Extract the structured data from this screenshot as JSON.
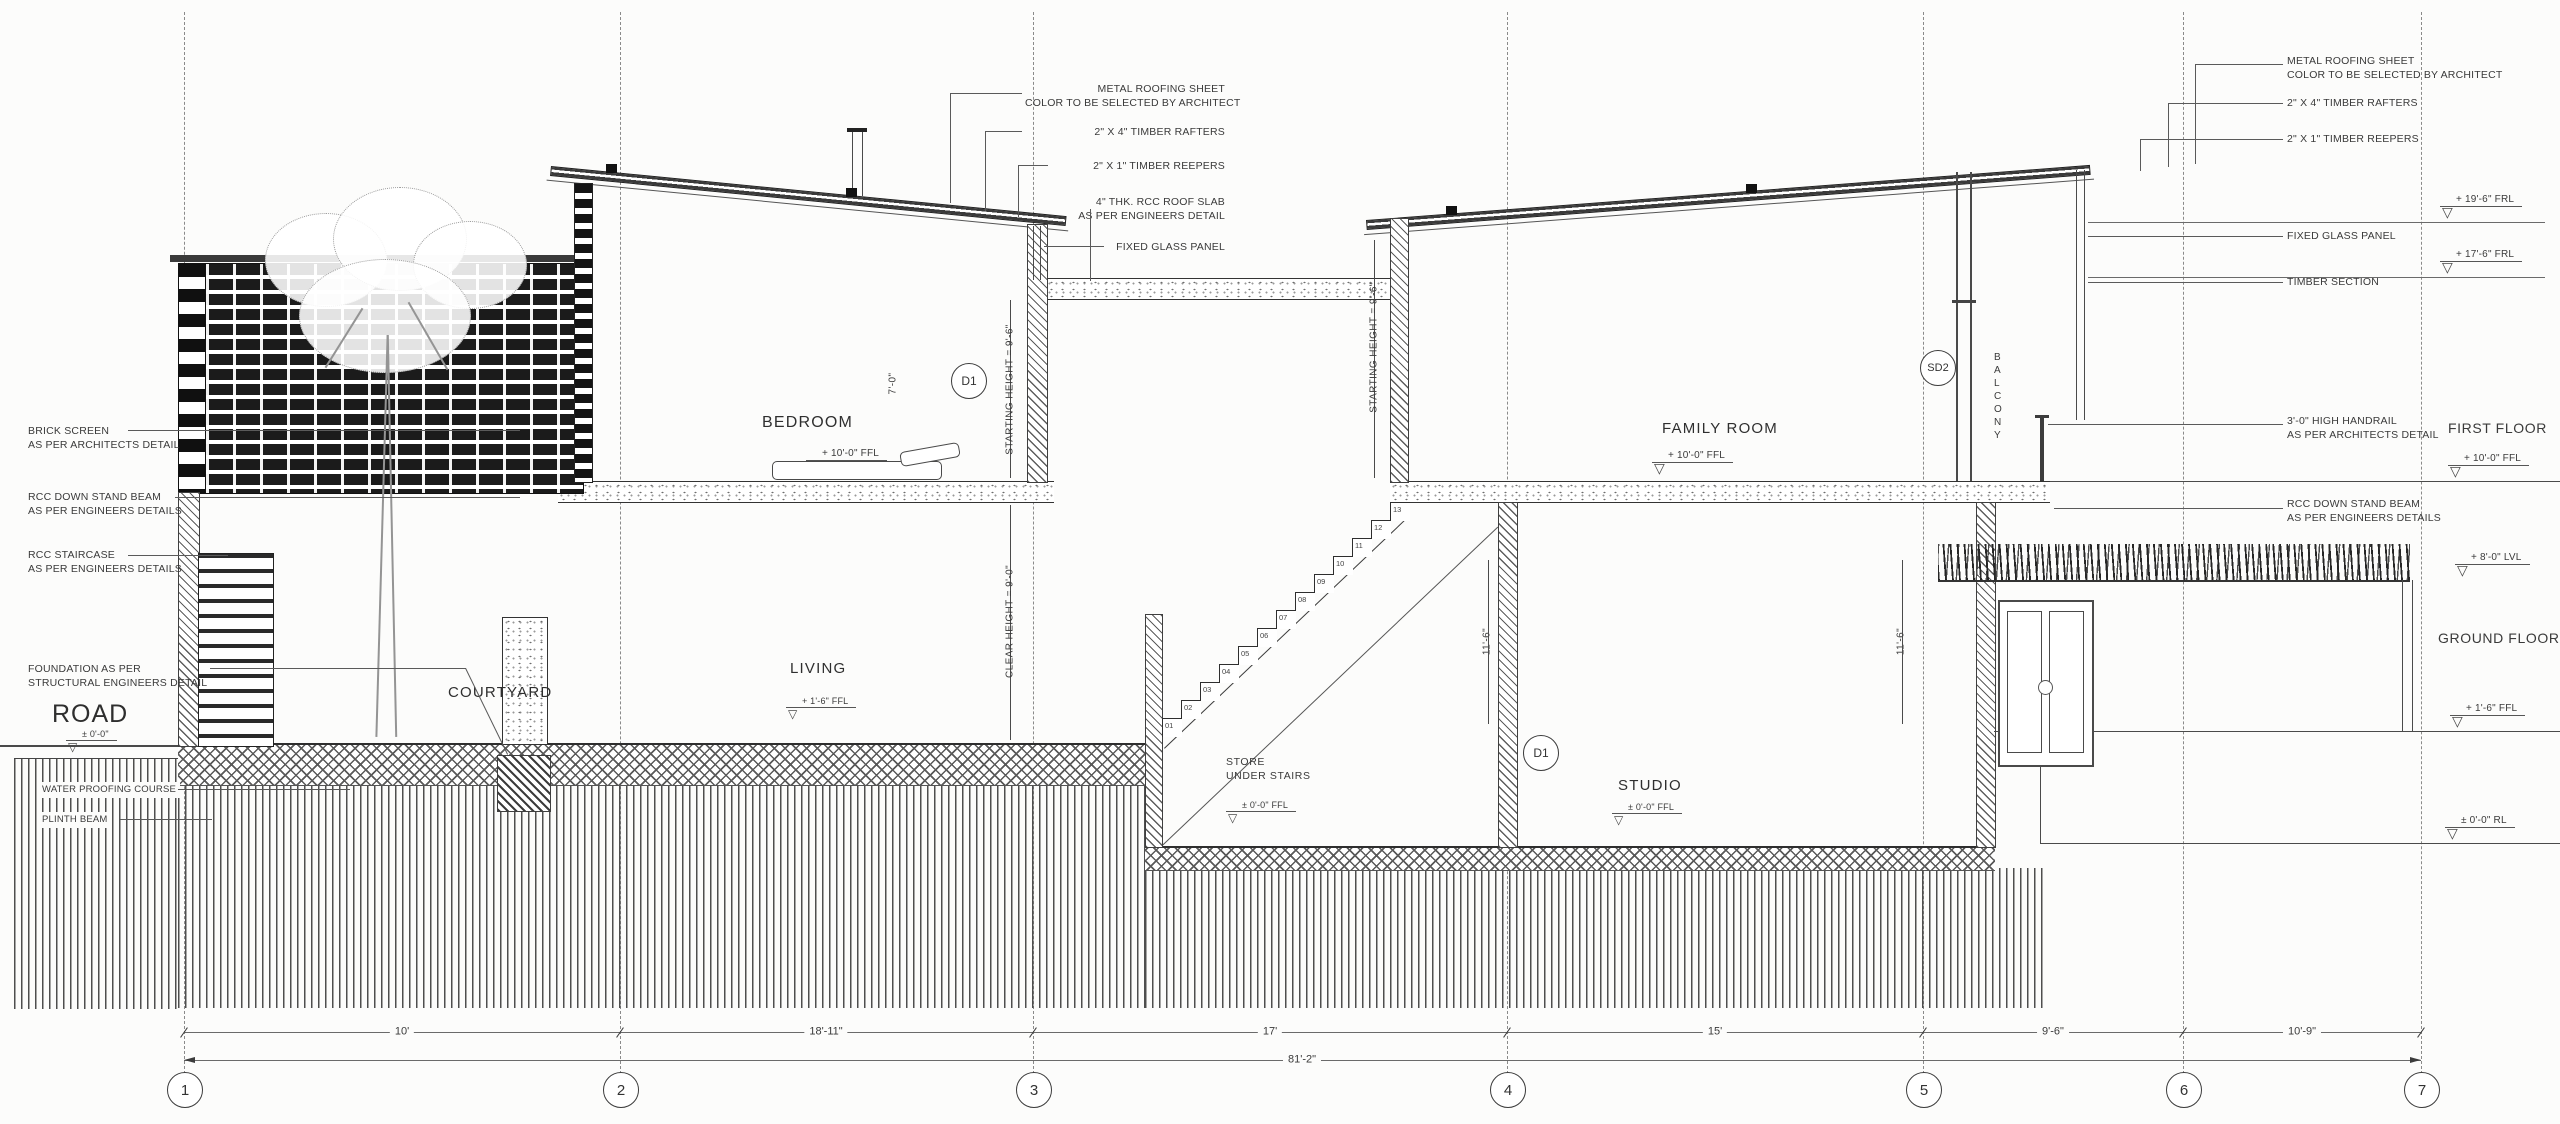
{
  "rooms": {
    "bedroom": {
      "label": "BEDROOM",
      "level": "+ 10'-0\" FFL"
    },
    "living": {
      "label": "LIVING",
      "level": "+ 1'-6\" FFL"
    },
    "courtyard": {
      "label": "COURTYARD"
    },
    "store": {
      "label_l1": "STORE",
      "label_l2": "UNDER STAIRS",
      "level": "± 0'-0\" FFL"
    },
    "studio": {
      "label": "STUDIO",
      "level": "± 0'-0\" FFL"
    },
    "family_room": {
      "label": "FAMILY ROOM",
      "level": "+ 10'-0\" FFL"
    },
    "balcony": {
      "letters": [
        "B",
        "A",
        "L",
        "C",
        "O",
        "N",
        "Y"
      ]
    },
    "road": {
      "label": "ROAD",
      "level": "± 0'-0\""
    }
  },
  "door_tags": {
    "bedroom": "D1",
    "studio": "D1",
    "balcony": "SD2"
  },
  "callouts": {
    "top_left": [
      {
        "l1": "METAL ROOFING SHEET",
        "l2": "COLOR TO BE SELECTED BY ARCHITECT"
      },
      {
        "l1": "2\" X 4\" TIMBER RAFTERS"
      },
      {
        "l1": "2\" X 1\" TIMBER REEPERS"
      },
      {
        "l1": "4\" THK. RCC ROOF SLAB",
        "l2": "AS PER ENGINEERS DETAIL"
      },
      {
        "l1": "FIXED GLASS PANEL"
      }
    ],
    "top_right": [
      {
        "l1": "METAL ROOFING SHEET",
        "l2": "COLOR TO BE SELECTED BY ARCHITECT"
      },
      {
        "l1": "2\" X 4\" TIMBER RAFTERS"
      },
      {
        "l1": "2\" X 1\" TIMBER REEPERS"
      },
      {
        "l1": "FIXED GLASS PANEL"
      },
      {
        "l1": "TIMBER SECTION"
      },
      {
        "l1": "3'-0\" HIGH HANDRAIL",
        "l2": "AS PER ARCHITECTS DETAIL"
      },
      {
        "l1": "RCC DOWN STAND BEAM",
        "l2": "AS PER ENGINEERS DETAILS"
      }
    ],
    "left": [
      {
        "l1": "BRICK SCREEN",
        "l2": "AS PER ARCHITECTS DETAIL"
      },
      {
        "l1": "RCC DOWN STAND BEAM",
        "l2": "AS PER ENGINEERS DETAILS"
      },
      {
        "l1": "RCC STAIRCASE",
        "l2": "AS PER ENGINEERS DETAILS"
      },
      {
        "l1": "FOUNDATION AS PER",
        "l2": "STRUCTURAL ENGINEERS DETAIL"
      },
      {
        "l1": "WATER PROOFING COURSE"
      },
      {
        "l1": "PLINTH BEAM"
      }
    ]
  },
  "levels_right": {
    "frl_high": "+ 19'-6\" FRL",
    "frl_low": "+ 17'-6\" FRL",
    "first_floor_label": "FIRST FLOOR",
    "first_floor_level": "+ 10'-0\" FFL",
    "terrace_level": "+ 8'-0\" LVL",
    "ground_floor_label": "GROUND FLOOR",
    "ground_floor_level": "+ 1'-6\" FFL",
    "road_level": "± 0'-0\" RL"
  },
  "height_dims": {
    "starting_height_bedroom": "STARTING HEIGHT = 9'-6\"",
    "starting_height_family": "STARTING HEIGHT = 9'-6\"",
    "clear_height_living": "CLEAR HEIGHT = 9'-0\"",
    "dim_store": "11'-6\"",
    "dim_studio": "11'-6\"",
    "dim_door": "7'-0\""
  },
  "grid": {
    "bubbles": [
      "1",
      "2",
      "3",
      "4",
      "5",
      "6",
      "7"
    ],
    "dims": [
      "10'",
      "18'-11\"",
      "17'",
      "15'",
      "9'-6\"",
      "10'-9\""
    ],
    "total": "81'-2\""
  },
  "stairs": {
    "risers": [
      "01",
      "02",
      "03",
      "04",
      "05",
      "06",
      "07",
      "08",
      "09",
      "10",
      "11",
      "12",
      "13"
    ]
  }
}
